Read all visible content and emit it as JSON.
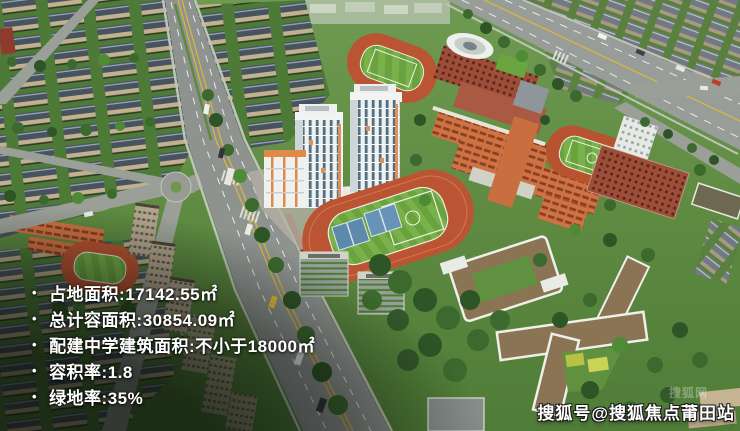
{
  "overlay": {
    "bullet": "•",
    "stats": [
      {
        "text": "占地面积:17142.55㎡"
      },
      {
        "text": "总计容面积:30854.09㎡"
      },
      {
        "text": "配建中学建筑面积:不小于18000㎡"
      },
      {
        "text": "容积率:1.8"
      },
      {
        "text": "绿地率:35%"
      }
    ]
  },
  "watermark": {
    "main": "搜狐号@搜狐焦点莆田站",
    "faint": "搜狐网"
  },
  "scene": {
    "palette": {
      "canopy_green": "#3c6a2e",
      "lawn_green": "#6e9a52",
      "field_green": "#6aa23d",
      "track_red": "#bb5433",
      "court_blue": "#5d8aac",
      "road_gray": "#8e9390",
      "school_orange": "#cf7344",
      "brick_red": "#9e4e38",
      "tower_white": "#eef1f1",
      "window_teal": "#54707e",
      "roof_brown": "#8b7454",
      "residential_roof": "#47535f",
      "marking_yellow": "#d9b53e",
      "text_white": "#ffffff"
    }
  }
}
